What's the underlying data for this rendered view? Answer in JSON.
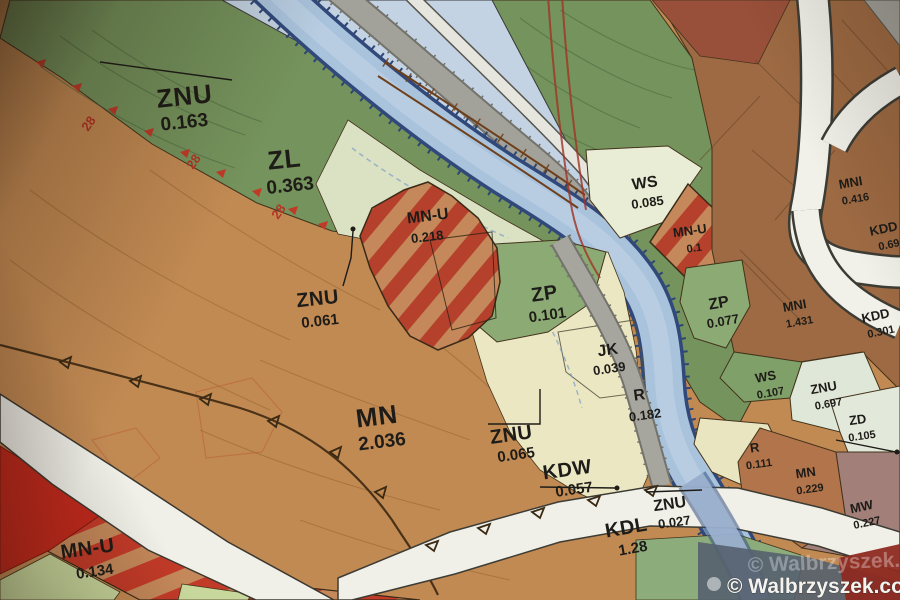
{
  "map": {
    "title": "zoning-plan-photo",
    "watermark": "© Walbrzyszek.com",
    "boundary_marks": [
      "28",
      "28",
      "28"
    ],
    "zones": {
      "znu_a": {
        "code": "ZNU",
        "value": "0.163"
      },
      "zl": {
        "code": "ZL",
        "value": "0.363"
      },
      "mnu_a": {
        "code": "MN-U",
        "value": "0.218"
      },
      "ws_a": {
        "code": "WS",
        "value": "0.085"
      },
      "mnu_b": {
        "code": "MN-U",
        "value": "0.1"
      },
      "znu_b": {
        "code": "ZNU",
        "value": "0.061"
      },
      "zp_a": {
        "code": "ZP",
        "value": "0.101"
      },
      "zp_b": {
        "code": "ZP",
        "value": "0.077"
      },
      "jk": {
        "code": "JK",
        "value": "0.039"
      },
      "r_a": {
        "code": "R",
        "value": "0.182"
      },
      "mn_a": {
        "code": "MN",
        "value": "2.036"
      },
      "znu_c": {
        "code": "ZNU",
        "value": "0.065"
      },
      "kdw": {
        "code": "KDW",
        "value": "0.057"
      },
      "ws_b": {
        "code": "WS",
        "value": "0.107"
      },
      "znu_d": {
        "code": "ZNU",
        "value": "0.697"
      },
      "mni_a": {
        "code": "MNI",
        "value": "0.416"
      },
      "kdd_a": {
        "code": "KDD",
        "value": "0.69"
      },
      "mni_b": {
        "code": "MNI",
        "value": "1.431"
      },
      "kdd_b": {
        "code": "KDD",
        "value": "0.301"
      },
      "zd": {
        "code": "ZD",
        "value": "0.105"
      },
      "r_b": {
        "code": "R",
        "value": "0.111"
      },
      "mn_b": {
        "code": "MN",
        "value": "0.229"
      },
      "mw": {
        "code": "MW",
        "value": "0.227"
      },
      "znu_e": {
        "code": "ZNU",
        "value": "0.027"
      },
      "kdl": {
        "code": "KDL",
        "value": "1.28"
      },
      "mnu_c": {
        "code": "MN-U",
        "value": "0.134"
      }
    },
    "colors": {
      "forest_green": "#75935c",
      "meadow_green": "#8cab74",
      "residential_orange": "#c28a53",
      "brown_mni": "#9d6a43",
      "mixed_use_stripe_red": "#b5402c",
      "solid_red": "#c1291c",
      "water_blue": "#a9c3dc",
      "road_white": "#f0f0e9",
      "road_gray": "#a2a19a",
      "cream_agriculture": "#ebe7c3",
      "pale_znu": "#dfe7d8",
      "mauve_mw": "#a28079"
    }
  }
}
